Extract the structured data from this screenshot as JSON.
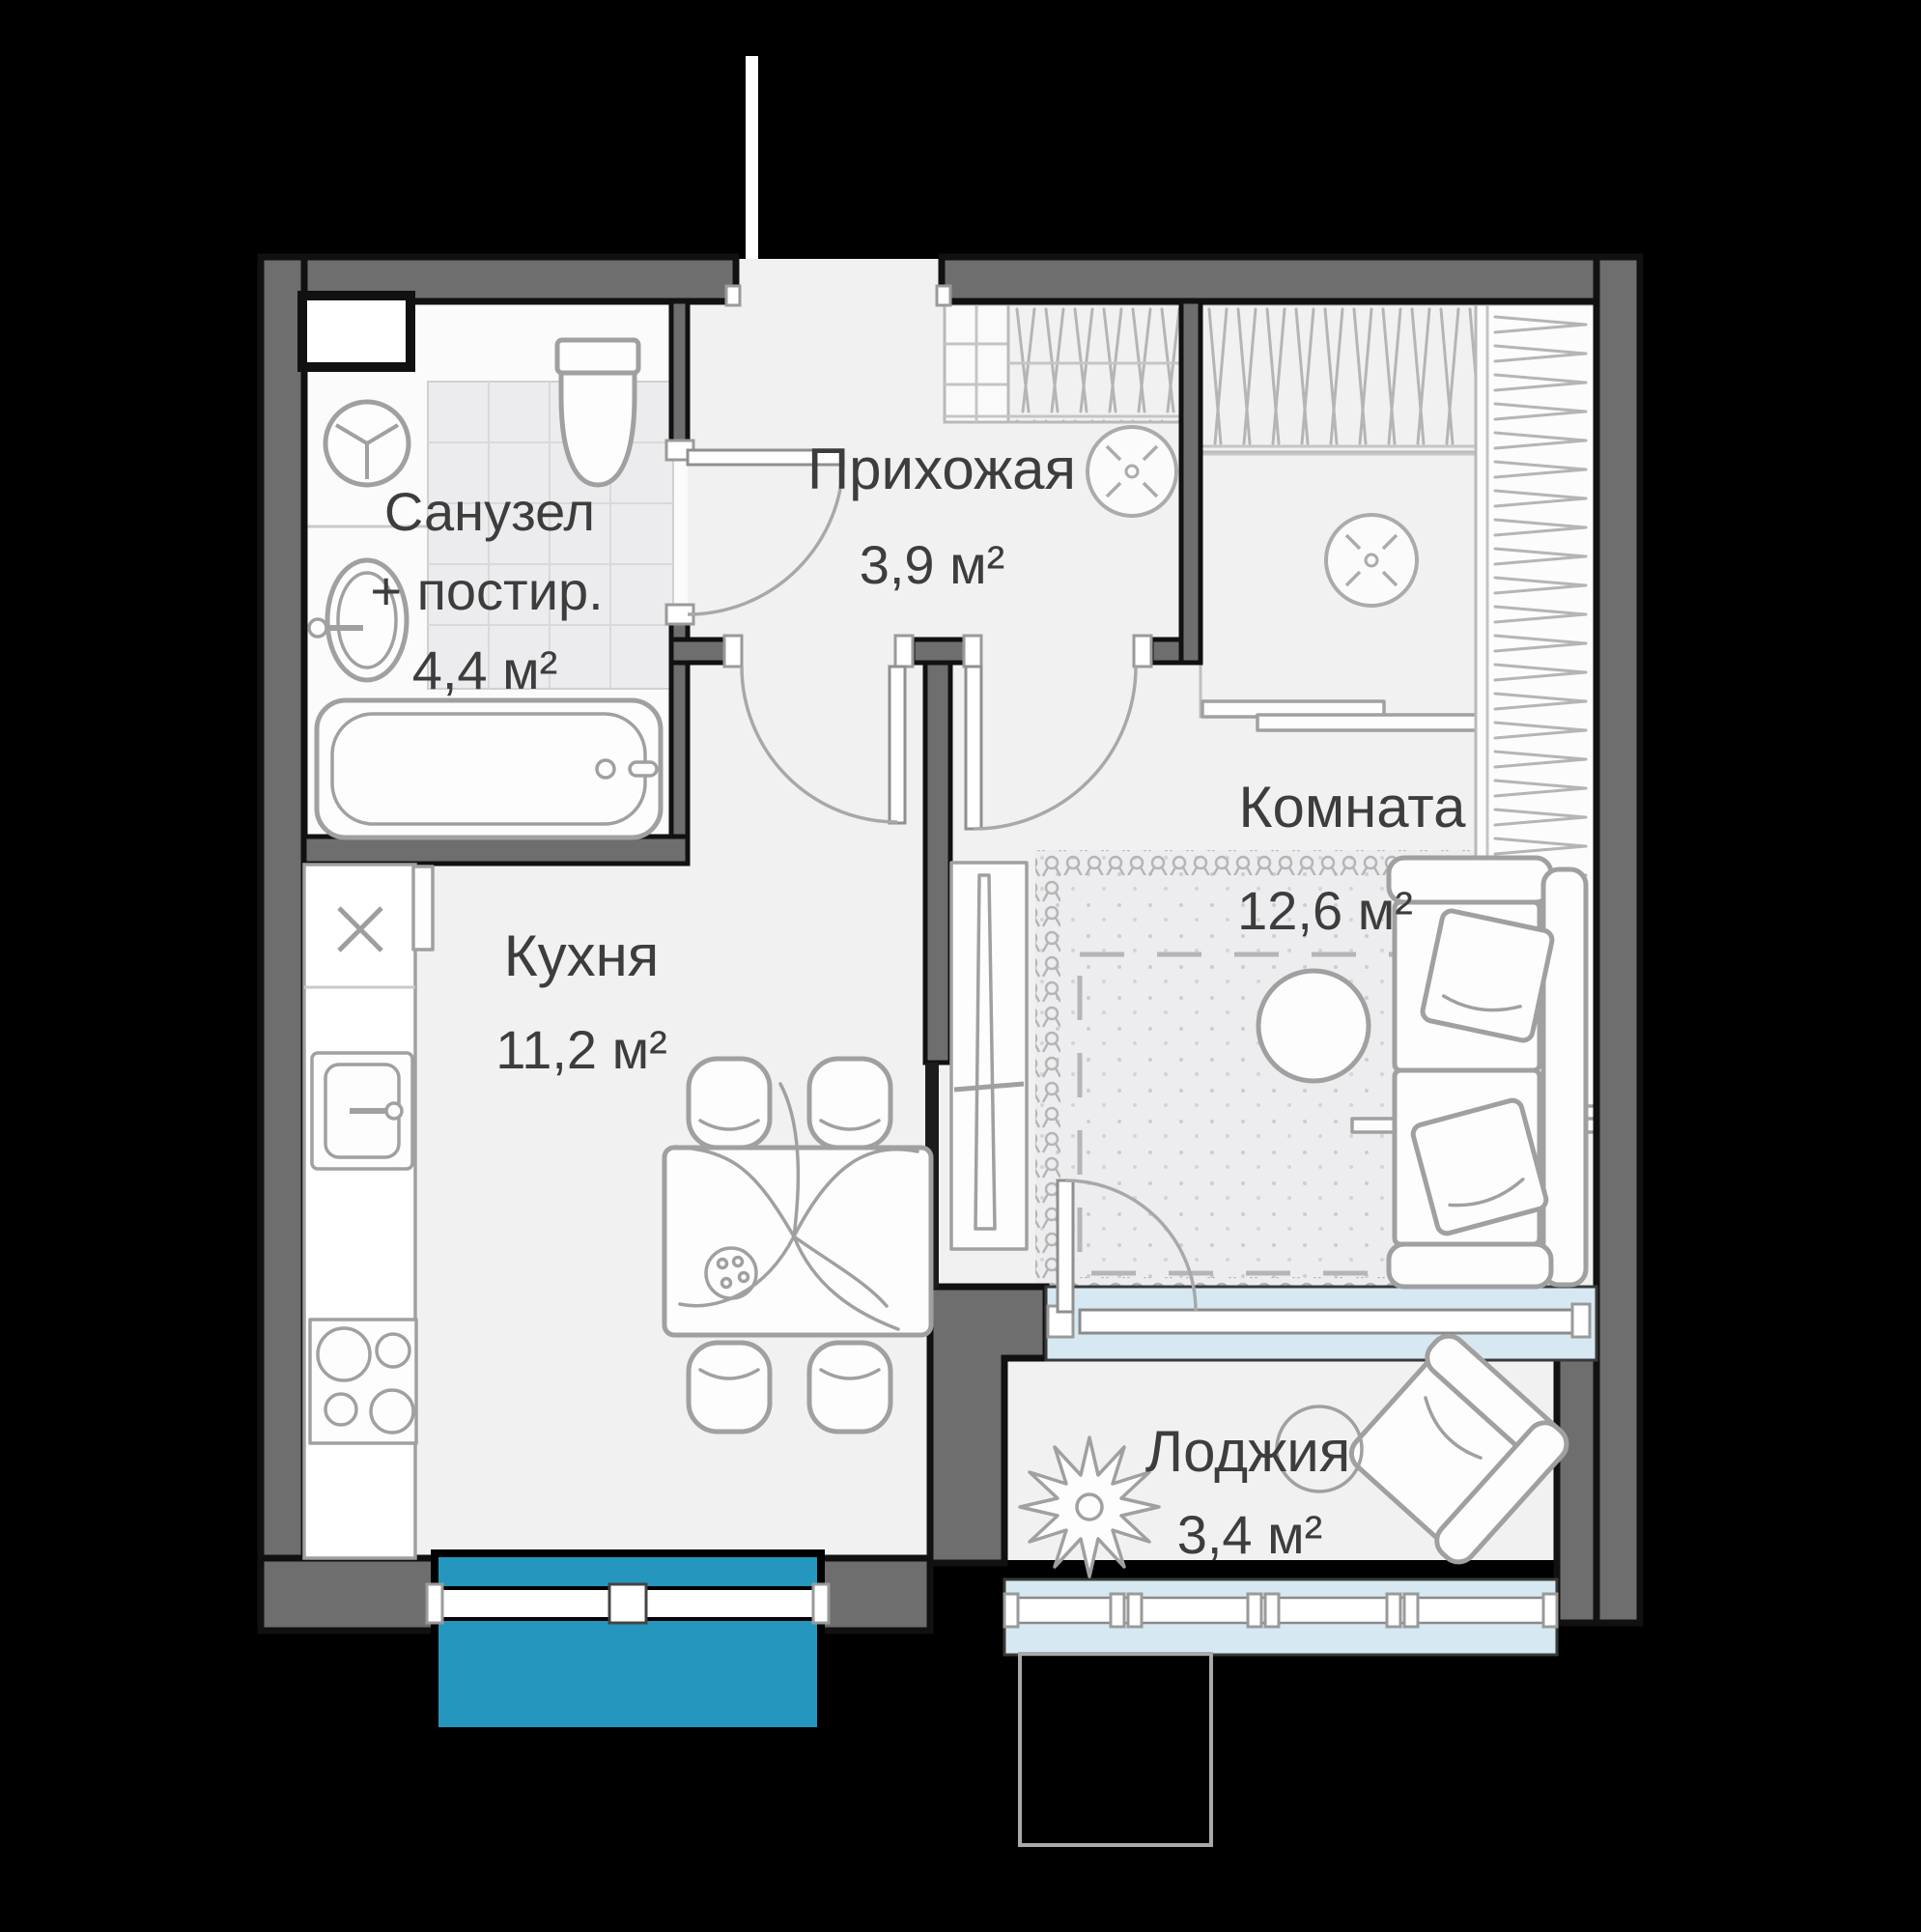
{
  "plan_type": "apartment-floor-plan",
  "colors": {
    "background": "#000000",
    "outer_wall": "#6e6e6e",
    "partition": "#1c1c1c",
    "floor": "#f1f1f2",
    "bathroom_floor": "#fbfbfc",
    "tile": "#ececee",
    "window_accent": "#2596be",
    "glazing_light": "#d6e9f2",
    "window_frame": "#ffffff",
    "furniture_stroke": "#a0a0a0",
    "hatch": "#b5b5b5",
    "label_text": "#3d3d3d"
  },
  "rooms": {
    "bathroom": {
      "name": "Санузел",
      "name_suffix": "+ постир.",
      "area": "4,4 м²"
    },
    "hallway": {
      "name": "Прихожая",
      "area": "3,9 м²"
    },
    "living_room": {
      "name": "Комната",
      "area": "12,6 м²"
    },
    "kitchen": {
      "name": "Кухня",
      "area": "11,2 м²"
    },
    "loggia": {
      "name": "Лоджия",
      "area": "3,4 м²"
    }
  },
  "icons": {
    "ceiling-light-icon": "circle with x-prongs",
    "washing-machine-icon": "circle with Y spokes",
    "vent-x-icon": "diagonal cross",
    "bathtub-icon": "rounded tub outline",
    "toilet-icon": "tank + bowl outline",
    "sink-icon": "oval basin",
    "kitchen-sink-icon": "square basin with faucet",
    "cooktop-icon": "four burner circles",
    "dining-table-icon": "rect with plant",
    "sofa-icon": "two-seat sofa outline",
    "armchair-icon": "rotated armchair outline",
    "plant-icon": "star burst leaves",
    "wardrobe-hatch-icon": "zigzag hatch",
    "rug-icon": "loop border carpet"
  }
}
